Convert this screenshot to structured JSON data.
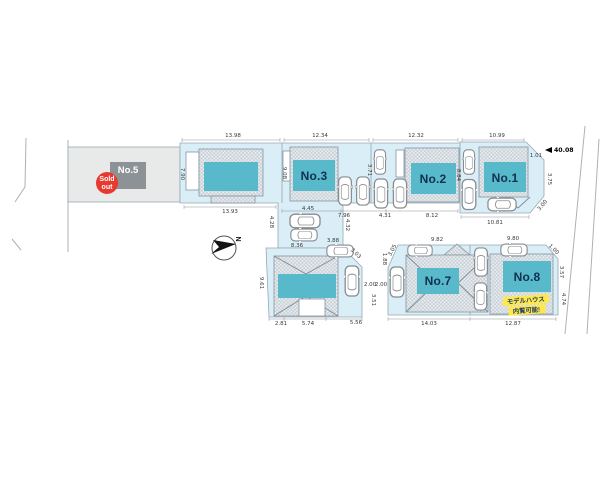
{
  "site_plan": {
    "north_label": "N",
    "sold_badge": {
      "line1": "Sold",
      "line2": "out"
    },
    "lots": {
      "no5": {
        "label": "No.5",
        "status": "sold"
      },
      "no3": {
        "label": "No.3"
      },
      "no2": {
        "label": "No.2"
      },
      "no1": {
        "label": "No.1"
      },
      "no7": {
        "label": "No.7"
      },
      "no8": {
        "label": "No.8",
        "note_line1": "モデルハウス",
        "note_line2": "内覧可能!"
      }
    },
    "dims": [
      "13.98",
      "12.34",
      "12.32",
      "10.99",
      "7.90",
      "13.93",
      "4.45",
      "7.96",
      "4.31",
      "8.12",
      "10.81",
      "1.01",
      "40.08",
      "3.75",
      "3.00",
      "8.84",
      "3.71",
      "9.08",
      "4.28",
      "4.32",
      "8.36",
      "3.88",
      "3.03",
      "9.61",
      "2.81",
      "5.74",
      "5.56",
      "2.00",
      "2.00",
      "3.51",
      "1.88",
      "3.05",
      "9.82",
      "9.80",
      "14.03",
      "12.87",
      "1.00",
      "3.57",
      "4.74"
    ],
    "colors": {
      "lot_fill": "#daeef7",
      "sold_lot_fill": "#e8e9e9",
      "building_gray": "#8d9296",
      "teal": "#57b9c9",
      "sold_red": "#e8392e",
      "note_yellow": "#ffe84d"
    }
  }
}
